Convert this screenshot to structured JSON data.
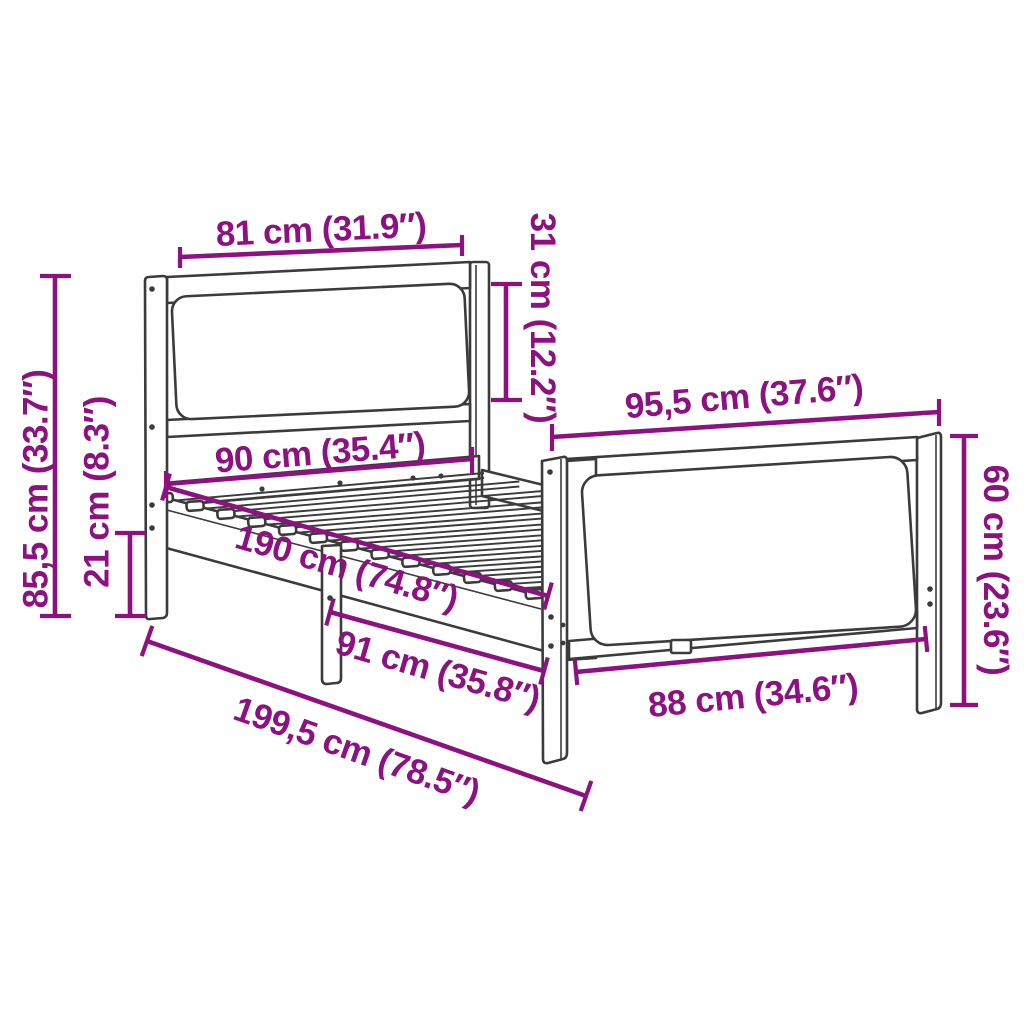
{
  "diagram": {
    "name": "bed-frame-dimension-diagram",
    "description": "Line drawing of a wooden bed frame with headboard and footboard cushions, annotated with dimensions"
  },
  "colors": {
    "accent": "#8e1181",
    "outline": "#3b3b3b",
    "background": "#ffffff"
  },
  "dims": {
    "headboard_width": {
      "label": "81 cm (31.9″)"
    },
    "headboard_panel_height": {
      "label": "31 cm (12.2″)"
    },
    "headboard_total_height": {
      "label": "85,5 cm (33.7″)"
    },
    "clearance_height": {
      "label": "21 cm (8.3″)"
    },
    "frame_width": {
      "label": "90 cm (35.4″)"
    },
    "inner_length": {
      "label": "190 cm (74.8″)"
    },
    "leg_span": {
      "label": "91 cm (35.8″)"
    },
    "footboard_width": {
      "label": "95,5 cm (37.6″)"
    },
    "footboard_inner_width": {
      "label": "88 cm (34.6″)"
    },
    "footboard_height": {
      "label": "60 cm (23.6″)"
    },
    "total_length": {
      "label": "199,5 cm (78.5″)"
    }
  }
}
